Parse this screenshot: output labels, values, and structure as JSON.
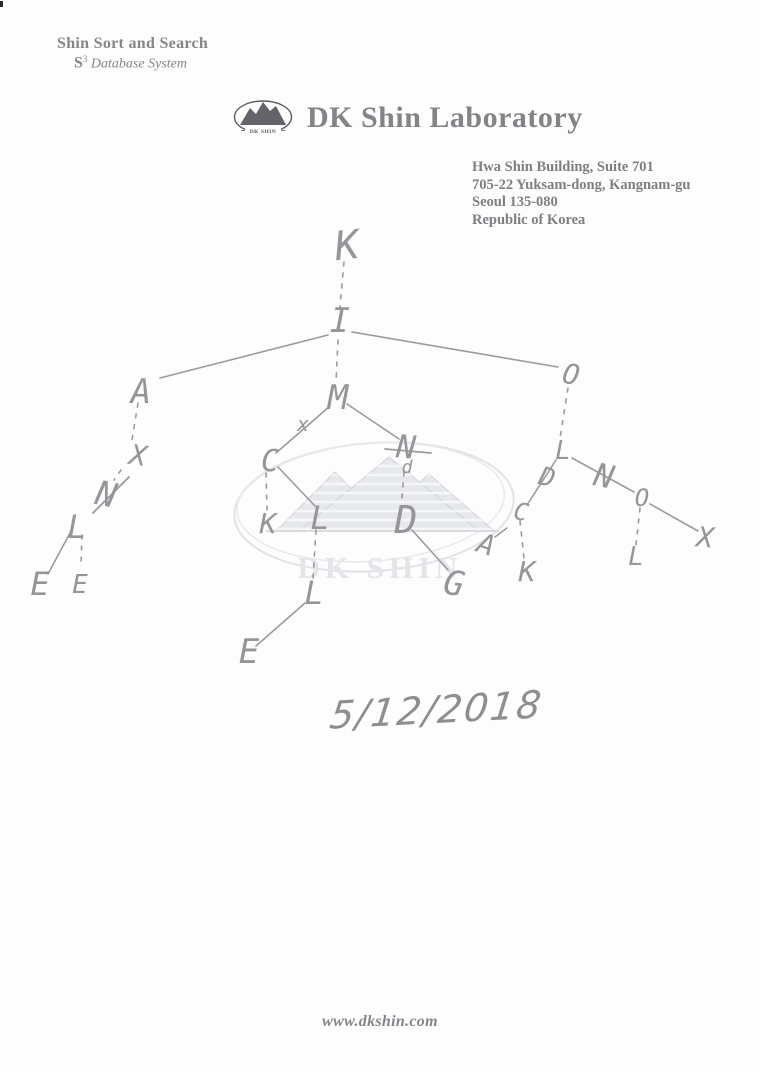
{
  "brand": {
    "tagline_title": "Shin Sort and Search",
    "tagline_sub_s": "S",
    "tagline_sub_sup": "3",
    "tagline_sub_rest": " Database System",
    "company": "DK Shin Laboratory",
    "logo_text": "DK SHIN"
  },
  "address": {
    "lines": [
      "Hwa Shin Building, Suite 701",
      "705-22 Yuksam-dong, Kangnam-gu",
      "Seoul 135-080",
      "Republic of Korea"
    ]
  },
  "watermark": {
    "text": "DK SHIN"
  },
  "handwriting": {
    "date": "5/12/2018"
  },
  "footer": {
    "website": "www.dkshin.com"
  },
  "tree": {
    "nodes": [
      {
        "label": "K",
        "x": 347,
        "y": 246,
        "size": 40,
        "rot": -6
      },
      {
        "label": "I",
        "x": 340,
        "y": 321,
        "size": 34,
        "rot": 0
      },
      {
        "label": "A",
        "x": 141,
        "y": 392,
        "size": 34,
        "rot": 0
      },
      {
        "label": "X",
        "x": 138,
        "y": 456,
        "size": 28,
        "rot": 8
      },
      {
        "label": "N",
        "x": 106,
        "y": 495,
        "size": 34,
        "rot": 12
      },
      {
        "label": "L",
        "x": 77,
        "y": 527,
        "size": 32,
        "rot": 0
      },
      {
        "label": "E",
        "x": 40,
        "y": 584,
        "size": 32,
        "rot": 0
      },
      {
        "label": "E",
        "x": 80,
        "y": 585,
        "size": 26,
        "rot": 0
      },
      {
        "label": "M",
        "x": 338,
        "y": 398,
        "size": 34,
        "rot": 0
      },
      {
        "label": "x",
        "x": 303,
        "y": 424,
        "size": 20,
        "rot": 0
      },
      {
        "label": "C",
        "x": 270,
        "y": 462,
        "size": 30,
        "rot": 0
      },
      {
        "label": "K",
        "x": 268,
        "y": 524,
        "size": 28,
        "rot": 0
      },
      {
        "label": "L",
        "x": 320,
        "y": 518,
        "size": 32,
        "rot": 0
      },
      {
        "label": "L",
        "x": 314,
        "y": 593,
        "size": 32,
        "rot": 0
      },
      {
        "label": "E",
        "x": 249,
        "y": 652,
        "size": 34,
        "rot": 0
      },
      {
        "label": "N",
        "x": 406,
        "y": 447,
        "size": 32,
        "rot": 5
      },
      {
        "label": "d",
        "x": 407,
        "y": 468,
        "size": 18,
        "rot": 0
      },
      {
        "label": "D",
        "x": 406,
        "y": 520,
        "size": 38,
        "rot": 0
      },
      {
        "label": "G",
        "x": 454,
        "y": 584,
        "size": 34,
        "rot": 10
      },
      {
        "label": "A",
        "x": 486,
        "y": 545,
        "size": 28,
        "rot": 18
      },
      {
        "label": "C",
        "x": 521,
        "y": 512,
        "size": 24,
        "rot": 10
      },
      {
        "label": "K",
        "x": 527,
        "y": 572,
        "size": 28,
        "rot": 0
      },
      {
        "label": "O",
        "x": 571,
        "y": 375,
        "size": 28,
        "rot": 10
      },
      {
        "label": "L",
        "x": 563,
        "y": 451,
        "size": 26,
        "rot": 0
      },
      {
        "label": "D",
        "x": 547,
        "y": 478,
        "size": 26,
        "rot": 15
      },
      {
        "label": "N",
        "x": 604,
        "y": 476,
        "size": 32,
        "rot": 12
      },
      {
        "label": "O",
        "x": 642,
        "y": 498,
        "size": 24,
        "rot": 0
      },
      {
        "label": "L",
        "x": 636,
        "y": 557,
        "size": 26,
        "rot": 0
      },
      {
        "label": "X",
        "x": 705,
        "y": 538,
        "size": 28,
        "rot": 5
      }
    ],
    "edges": [
      {
        "x1": 344,
        "y1": 262,
        "x2": 340,
        "y2": 307,
        "style": "dashed"
      },
      {
        "x1": 328,
        "y1": 335,
        "x2": 160,
        "y2": 378,
        "style": "solid"
      },
      {
        "x1": 352,
        "y1": 332,
        "x2": 558,
        "y2": 367,
        "style": "solid"
      },
      {
        "x1": 338,
        "y1": 340,
        "x2": 336,
        "y2": 382,
        "style": "dashed"
      },
      {
        "x1": 138,
        "y1": 403,
        "x2": 132,
        "y2": 440,
        "style": "dashed"
      },
      {
        "x1": 121,
        "y1": 470,
        "x2": 114,
        "y2": 480,
        "style": "dashed"
      },
      {
        "x1": 70,
        "y1": 533,
        "x2": 48,
        "y2": 574,
        "style": "solid"
      },
      {
        "x1": 82,
        "y1": 535,
        "x2": 81,
        "y2": 567,
        "style": "dashed"
      },
      {
        "x1": 330,
        "y1": 406,
        "x2": 276,
        "y2": 453,
        "style": "solid"
      },
      {
        "x1": 347,
        "y1": 404,
        "x2": 399,
        "y2": 439,
        "style": "solid"
      },
      {
        "x1": 266,
        "y1": 473,
        "x2": 267,
        "y2": 510,
        "style": "dashed"
      },
      {
        "x1": 278,
        "y1": 467,
        "x2": 315,
        "y2": 506,
        "style": "solid"
      },
      {
        "x1": 316,
        "y1": 530,
        "x2": 313,
        "y2": 578,
        "style": "dashed"
      },
      {
        "x1": 305,
        "y1": 603,
        "x2": 256,
        "y2": 646,
        "style": "solid"
      },
      {
        "x1": 404,
        "y1": 472,
        "x2": 402,
        "y2": 498,
        "style": "dashed"
      },
      {
        "x1": 412,
        "y1": 530,
        "x2": 448,
        "y2": 570,
        "style": "solid"
      },
      {
        "x1": 495,
        "y1": 537,
        "x2": 507,
        "y2": 528,
        "style": "solid"
      },
      {
        "x1": 520,
        "y1": 521,
        "x2": 524,
        "y2": 558,
        "style": "dashed"
      },
      {
        "x1": 568,
        "y1": 388,
        "x2": 560,
        "y2": 438,
        "style": "dashed"
      },
      {
        "x1": 556,
        "y1": 460,
        "x2": 527,
        "y2": 505,
        "style": "solid"
      },
      {
        "x1": 572,
        "y1": 458,
        "x2": 634,
        "y2": 492,
        "style": "solid"
      },
      {
        "x1": 640,
        "y1": 508,
        "x2": 636,
        "y2": 545,
        "style": "dashed"
      },
      {
        "x1": 650,
        "y1": 504,
        "x2": 698,
        "y2": 531,
        "style": "solid"
      }
    ],
    "strikes": [
      {
        "x1": 93,
        "y1": 513,
        "x2": 129,
        "y2": 477
      },
      {
        "x1": 385,
        "y1": 449,
        "x2": 431,
        "y2": 453
      }
    ]
  }
}
